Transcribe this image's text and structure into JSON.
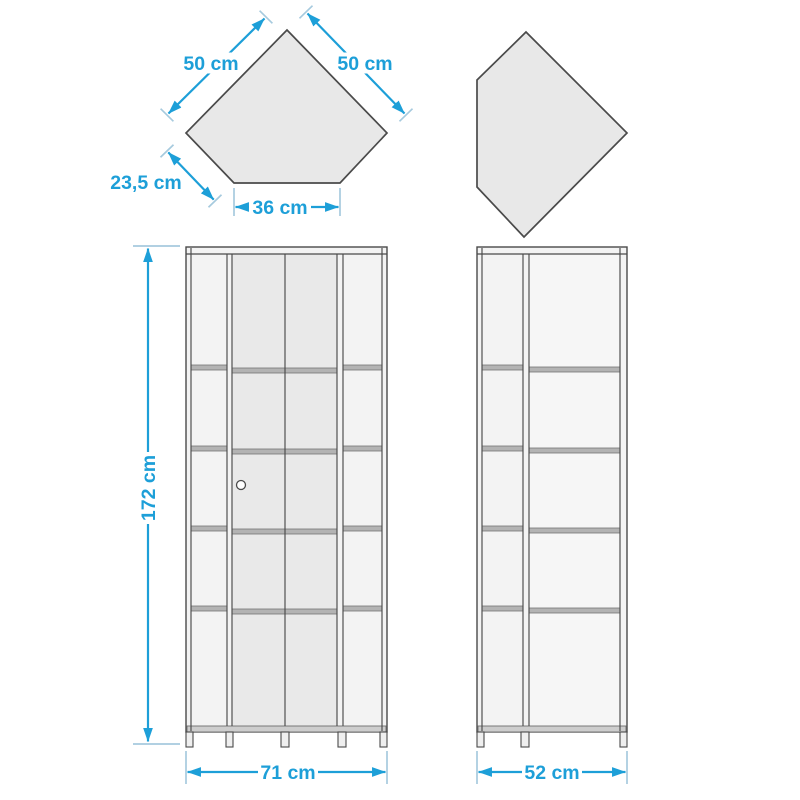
{
  "colors": {
    "dimension": "#1d9fd8",
    "extension": "#a6cade",
    "outline": "#4a4a4a",
    "panel": "#f3f3f3",
    "glass": "#e9e9e9",
    "shelf": "#b3b3b3",
    "shape_fill": "#e8e8e8"
  },
  "top_view": {
    "edge_left": "50 cm",
    "edge_right": "50 cm",
    "edge_side": "23,5 cm",
    "edge_front": "36 cm"
  },
  "front_view": {
    "height": "172 cm",
    "width": "71 cm"
  },
  "side_view": {
    "width": "52 cm"
  }
}
